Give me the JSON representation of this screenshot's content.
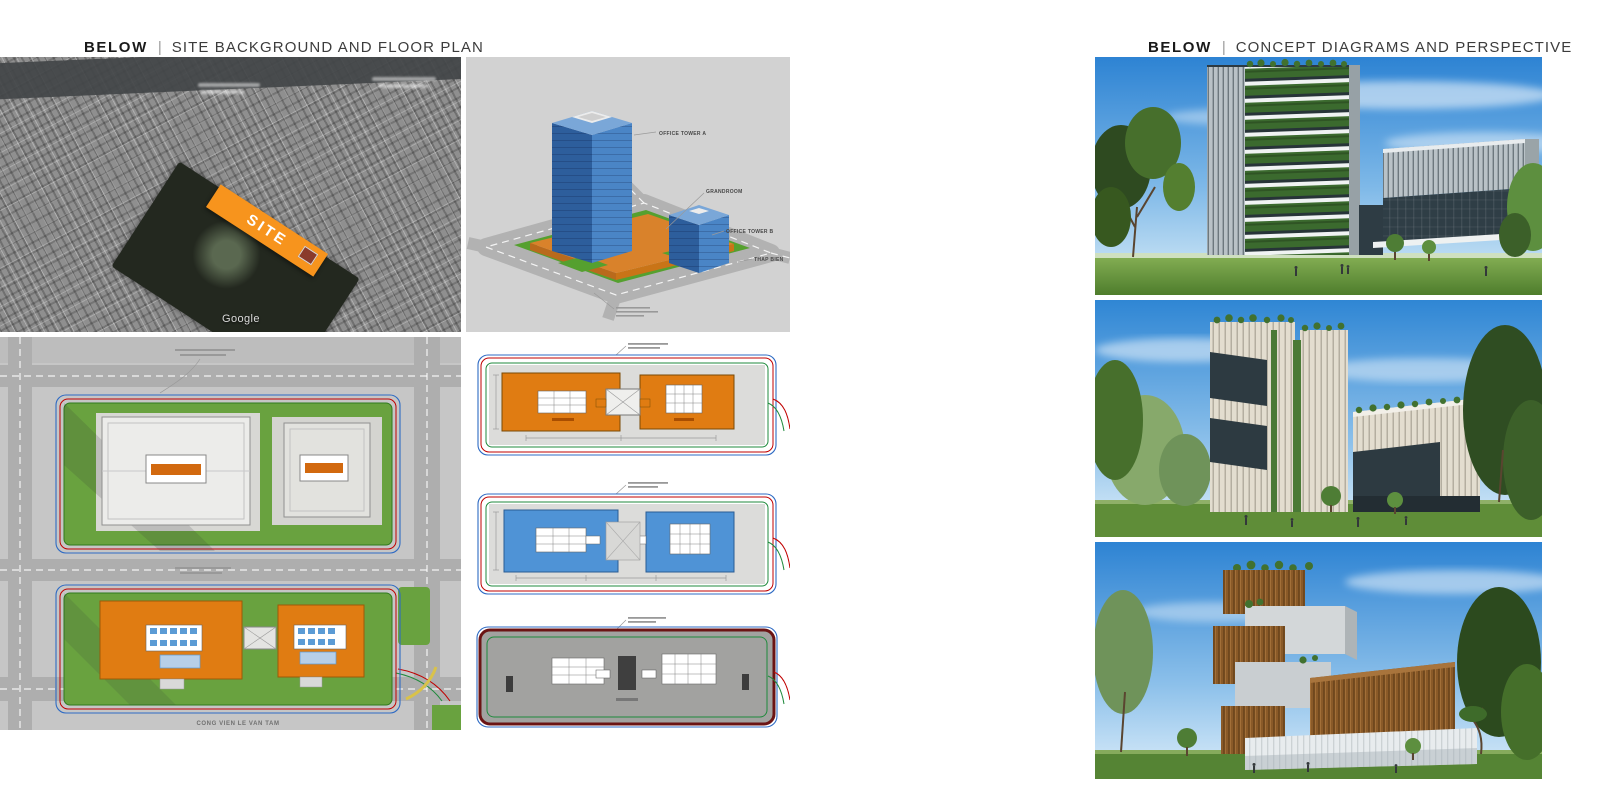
{
  "page": {
    "background": "#ffffff"
  },
  "left_section": {
    "heading": {
      "prefix": "BELOW",
      "separator": "|",
      "title": "SITE BACKGROUND AND FLOOR PLAN"
    },
    "aerial_map": {
      "site_label": "SITE",
      "watermark": "Google"
    },
    "axonometric": {
      "labels": {
        "tower_a": "OFFICE TOWER A",
        "grandroom": "GRANDROOM",
        "tower_b": "OFFICE TOWER B",
        "side_note": "THAP BIEN"
      }
    },
    "master_plan": {
      "park_label": "CONG VIEN LE VAN TAM"
    }
  },
  "right_section": {
    "heading": {
      "prefix": "BELOW",
      "separator": "|",
      "title": "CONCEPT DIAGRAMS AND PERSPECTIVE"
    }
  },
  "colors": {
    "site_orange": "#F7941D",
    "plan_orange": "#E07C12",
    "plan_blue": "#4F93D6",
    "tower_blue": "#3E76B5",
    "parcel_green": "#69A23F",
    "boundary_red": "#C00000",
    "boundary_green": "#1F8A3C",
    "boundary_blue": "#2F6BC4"
  }
}
